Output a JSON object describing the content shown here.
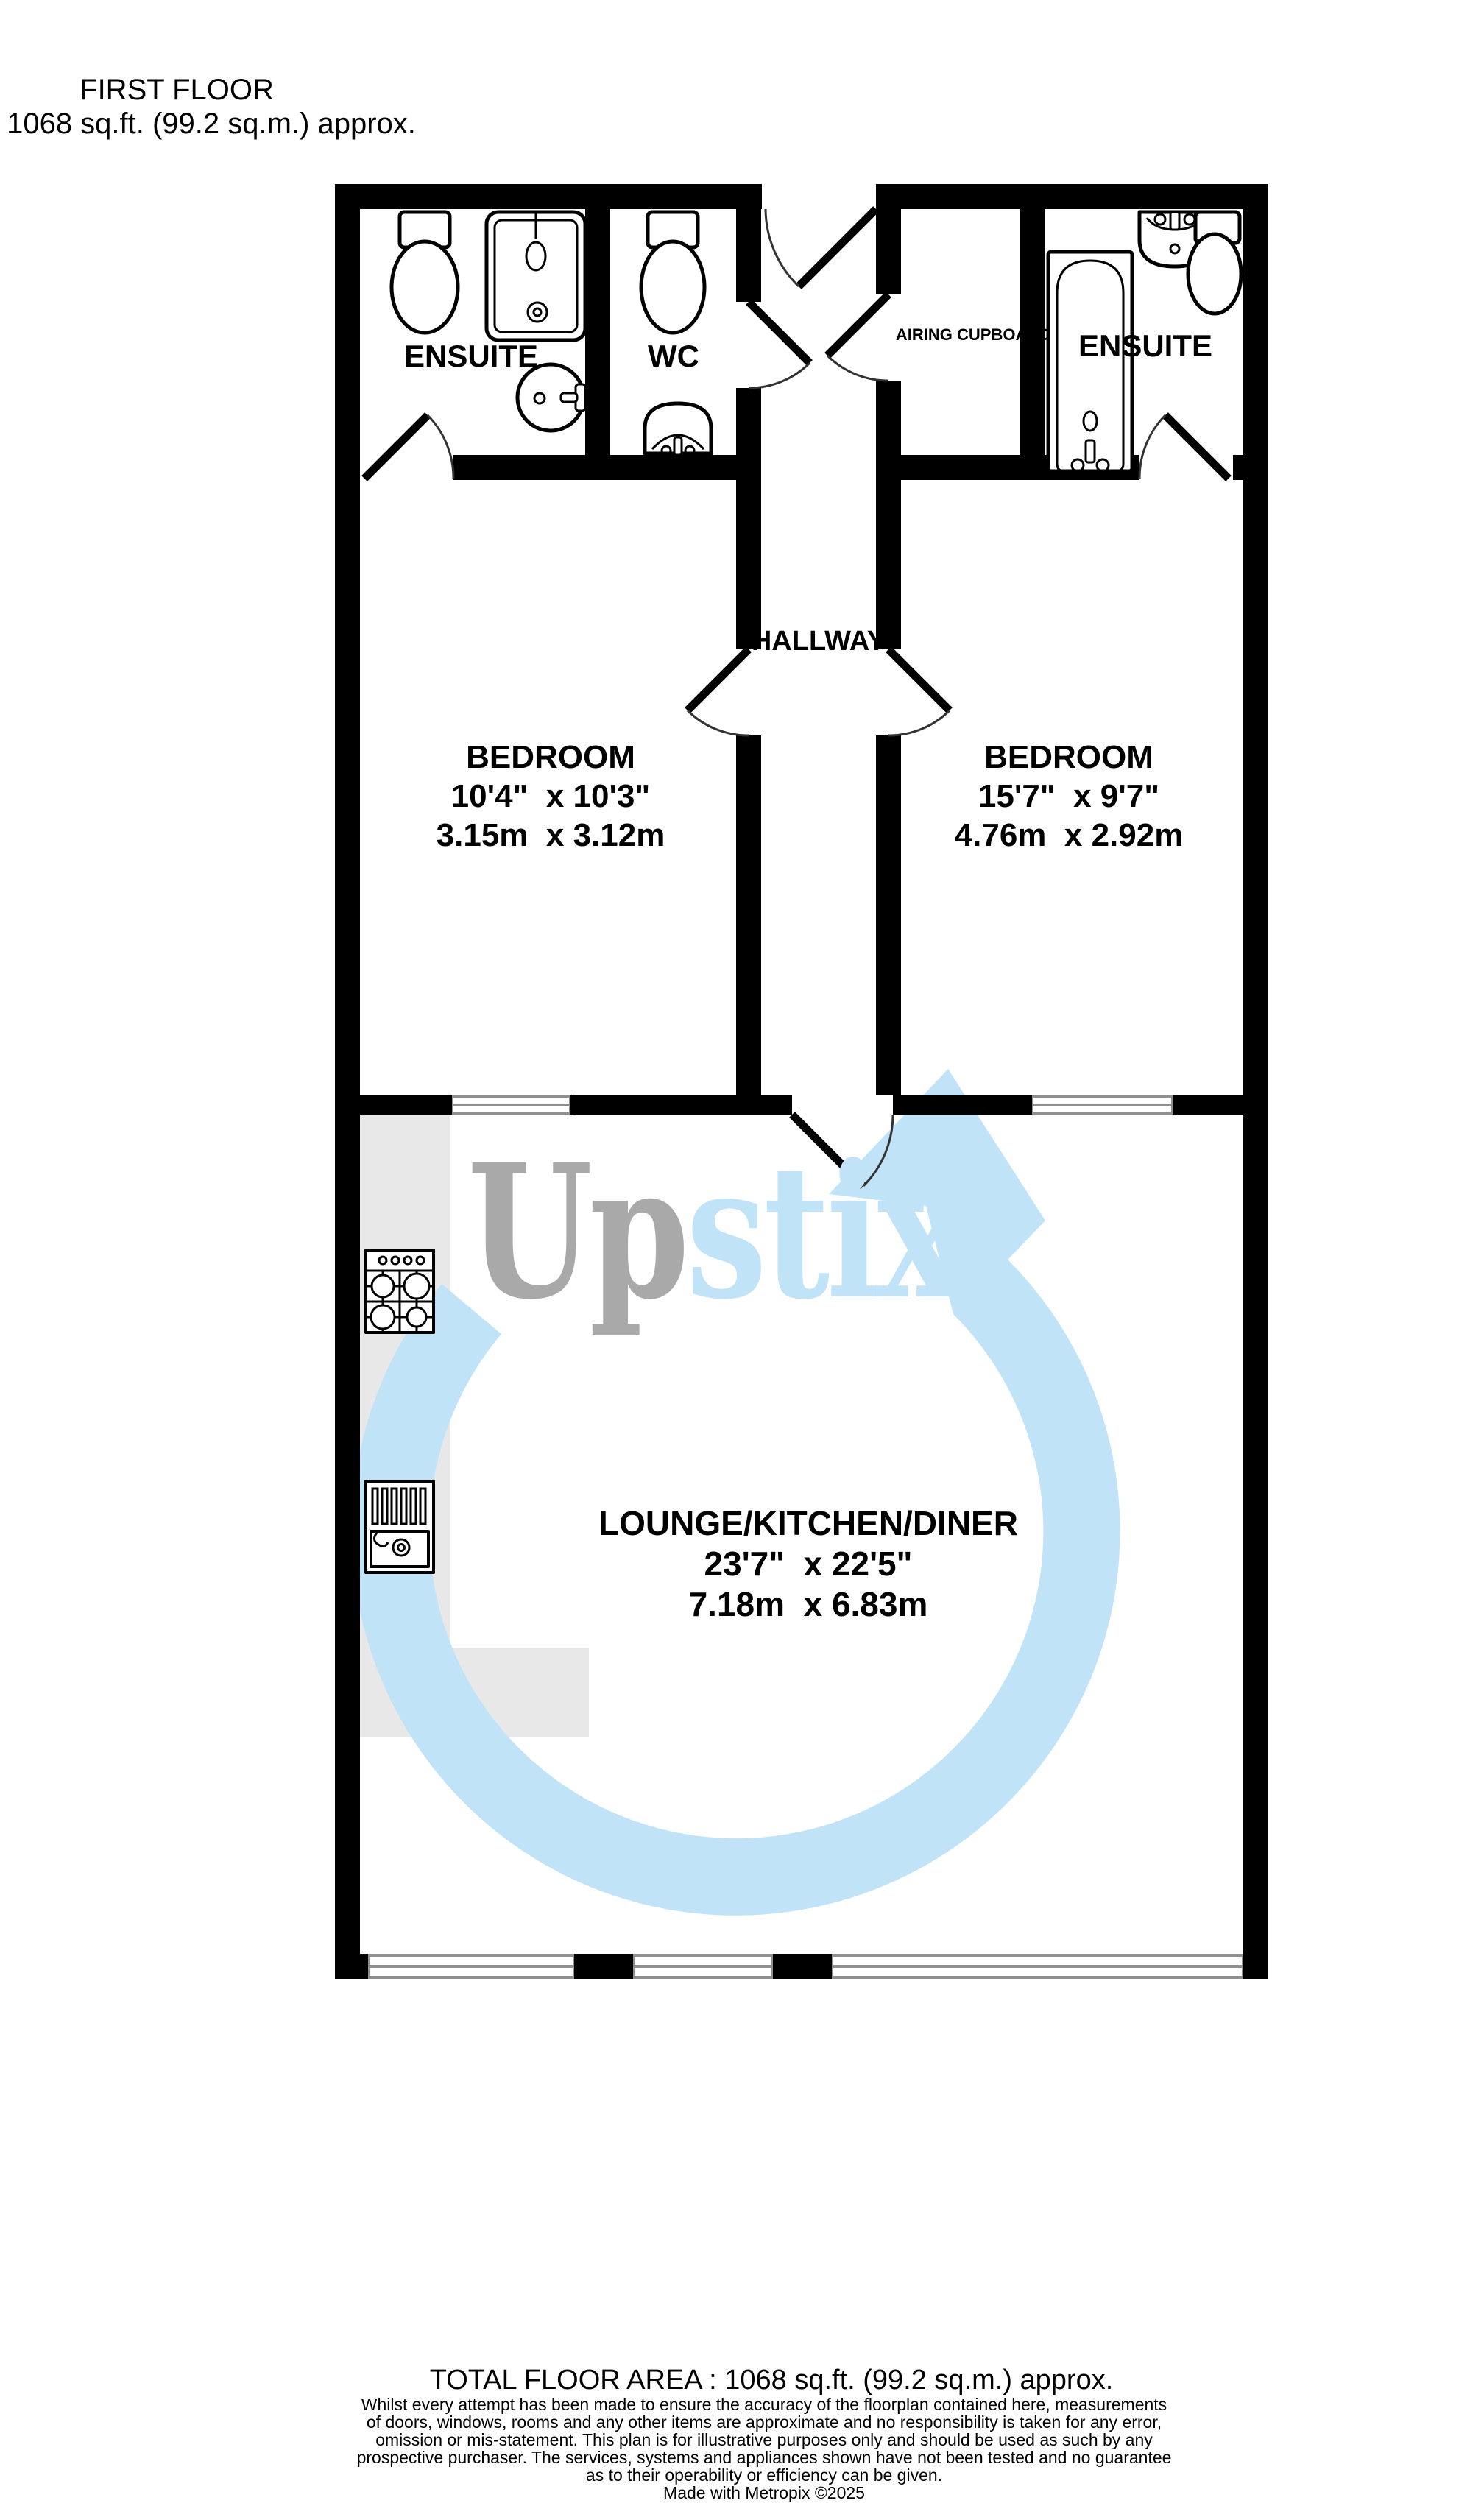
{
  "header": {
    "floor_label": "FIRST FLOOR",
    "floor_area": "1068 sq.ft. (99.2 sq.m.) approx."
  },
  "rooms": {
    "ensuite_left": {
      "label": "ENSUITE"
    },
    "wc": {
      "label": "WC"
    },
    "airing_cupboard": {
      "label": "AIRING CUPBOARD"
    },
    "ensuite_right": {
      "label": "ENSUITE"
    },
    "hallway": {
      "label": "HALLWAY"
    },
    "bedroom_left": {
      "label": "BEDROOM",
      "size_imperial": "10'4\"  x 10'3\"",
      "size_metric": "3.15m  x 3.12m"
    },
    "bedroom_right": {
      "label": "BEDROOM",
      "size_imperial": "15'7\"  x 9'7\"",
      "size_metric": "4.76m  x 2.92m"
    },
    "lounge": {
      "label": "LOUNGE/KITCHEN/DINER",
      "size_imperial": "23'7\"  x 22'5\"",
      "size_metric": "7.18m  x 6.83m"
    }
  },
  "watermark": {
    "text_gray": "Up",
    "text_blue": "stix",
    "gray_color": "#a9a9a9",
    "blue_color": "#c0e3f8"
  },
  "footer": {
    "total_area": "TOTAL FLOOR AREA : 1068 sq.ft. (99.2 sq.m.) approx.",
    "disclaimer_lines": [
      "Whilst every attempt has been made to ensure the accuracy of the floorplan contained here, measurements",
      "of doors, windows, rooms and any other items are approximate and no responsibility is taken for any error,",
      "omission or mis-statement. This plan is for illustrative purposes only and should be used as such by any",
      "prospective purchaser. The services, systems and appliances shown have not been tested and no guarantee",
      "as to their operability or efficiency can be given."
    ],
    "credit": "Made with Metropix ©2025"
  },
  "colors": {
    "wall": "#000000",
    "window_line": "#8f8f8f",
    "counter": "#e8e8e8",
    "door_arc": "#333333"
  }
}
